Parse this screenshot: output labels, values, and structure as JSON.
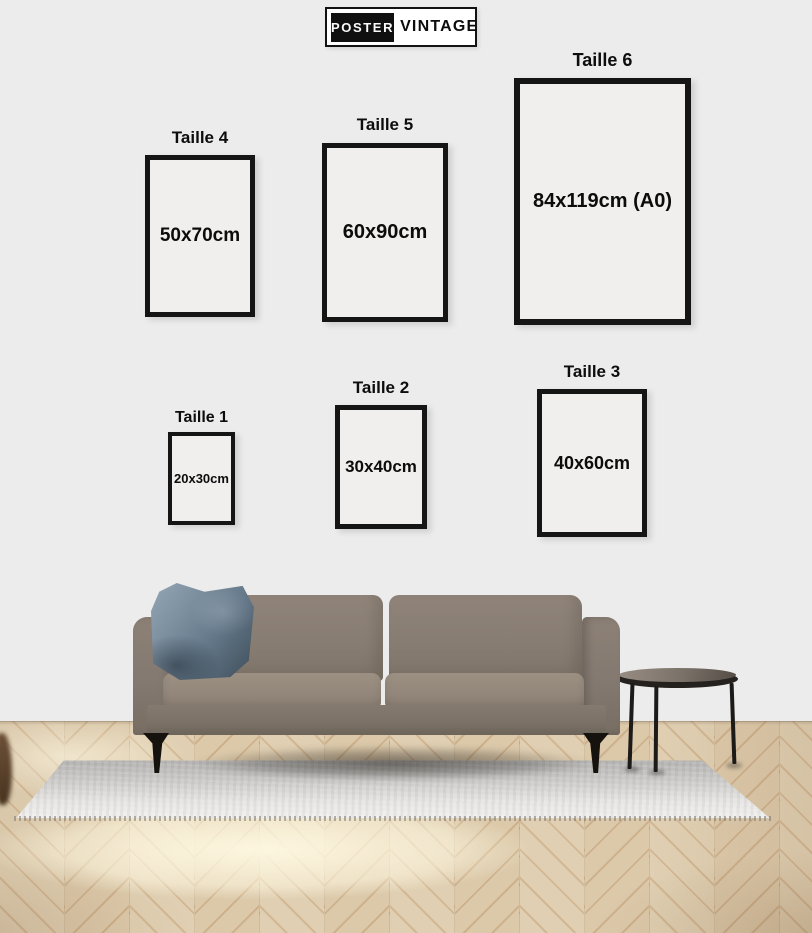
{
  "brand": {
    "poster": "POSTER",
    "vintage": "VINTAGE"
  },
  "frames": [
    {
      "label": "Taille 4",
      "size": "50x70cm"
    },
    {
      "label": "Taille 5",
      "size": "60x90cm"
    },
    {
      "label": "Taille 6",
      "size": "84x119cm (A0)"
    },
    {
      "label": "Taille 1",
      "size": "20x30cm"
    },
    {
      "label": "Taille 2",
      "size": "30x40cm"
    },
    {
      "label": "Taille 3",
      "size": "40x60cm"
    }
  ],
  "colors": {
    "wall": "#ececec",
    "frame_fill": "#f0efee",
    "frame_border": "#151515",
    "label_text": "#0d0d0d",
    "sofa_body": "#8a7e73",
    "pillow_blue": "#6d8192",
    "rug_light": "#e7e6e4",
    "floor_light_plank": "#e0cfb2",
    "floor_dark_plank": "#cdb18c",
    "table_black": "#1d1b19",
    "logo_black": "#101010",
    "logo_white": "#ffffff"
  }
}
